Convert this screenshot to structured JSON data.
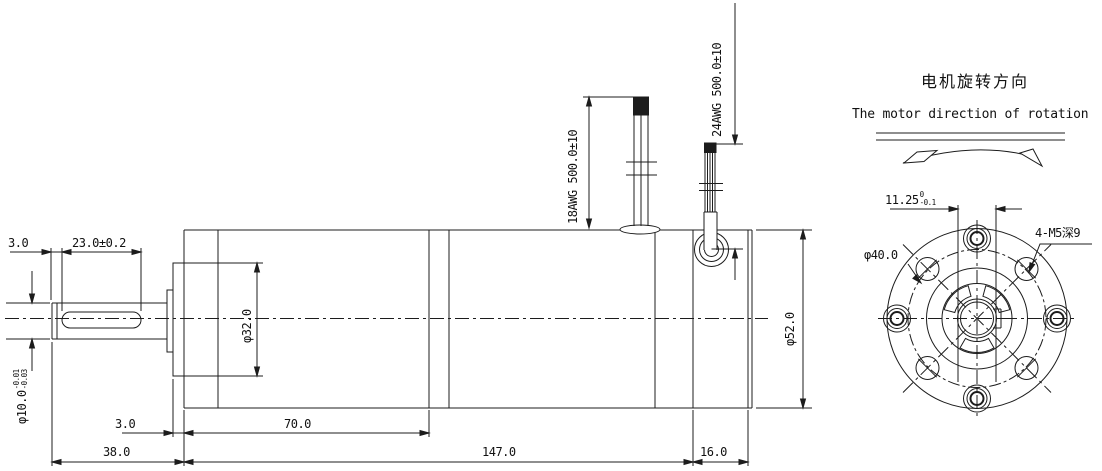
{
  "drawing": {
    "background": "#ffffff",
    "line_color": "#1c1c1c"
  },
  "side_view": {
    "dims": {
      "tip_len": "3.0",
      "flat_len": "23.0±0.2",
      "shaft_dia": "φ10.0",
      "shaft_dia_tol_up": "-0.01",
      "shaft_dia_tol_low": "-0.03",
      "boss_len": "3.0",
      "gearbox_len": "70.0",
      "shaft_len": "38.0",
      "body_len": "147.0",
      "rear_len": "16.0",
      "pilot_dia": "φ32.0",
      "body_dia": "φ52.0",
      "wire18": "18AWG 500.0±10",
      "wire24": "24AWG 500.0±10"
    }
  },
  "end_view": {
    "bolt_circle_dia": "φ40.0",
    "thread_spec": "4-M5深9",
    "key_width": "11.25",
    "key_tol_up": "0",
    "key_tol_low": "-0.1"
  },
  "rotation_note": {
    "title_cn": "电机旋转方向",
    "title_en": "The motor direction of rotation"
  }
}
